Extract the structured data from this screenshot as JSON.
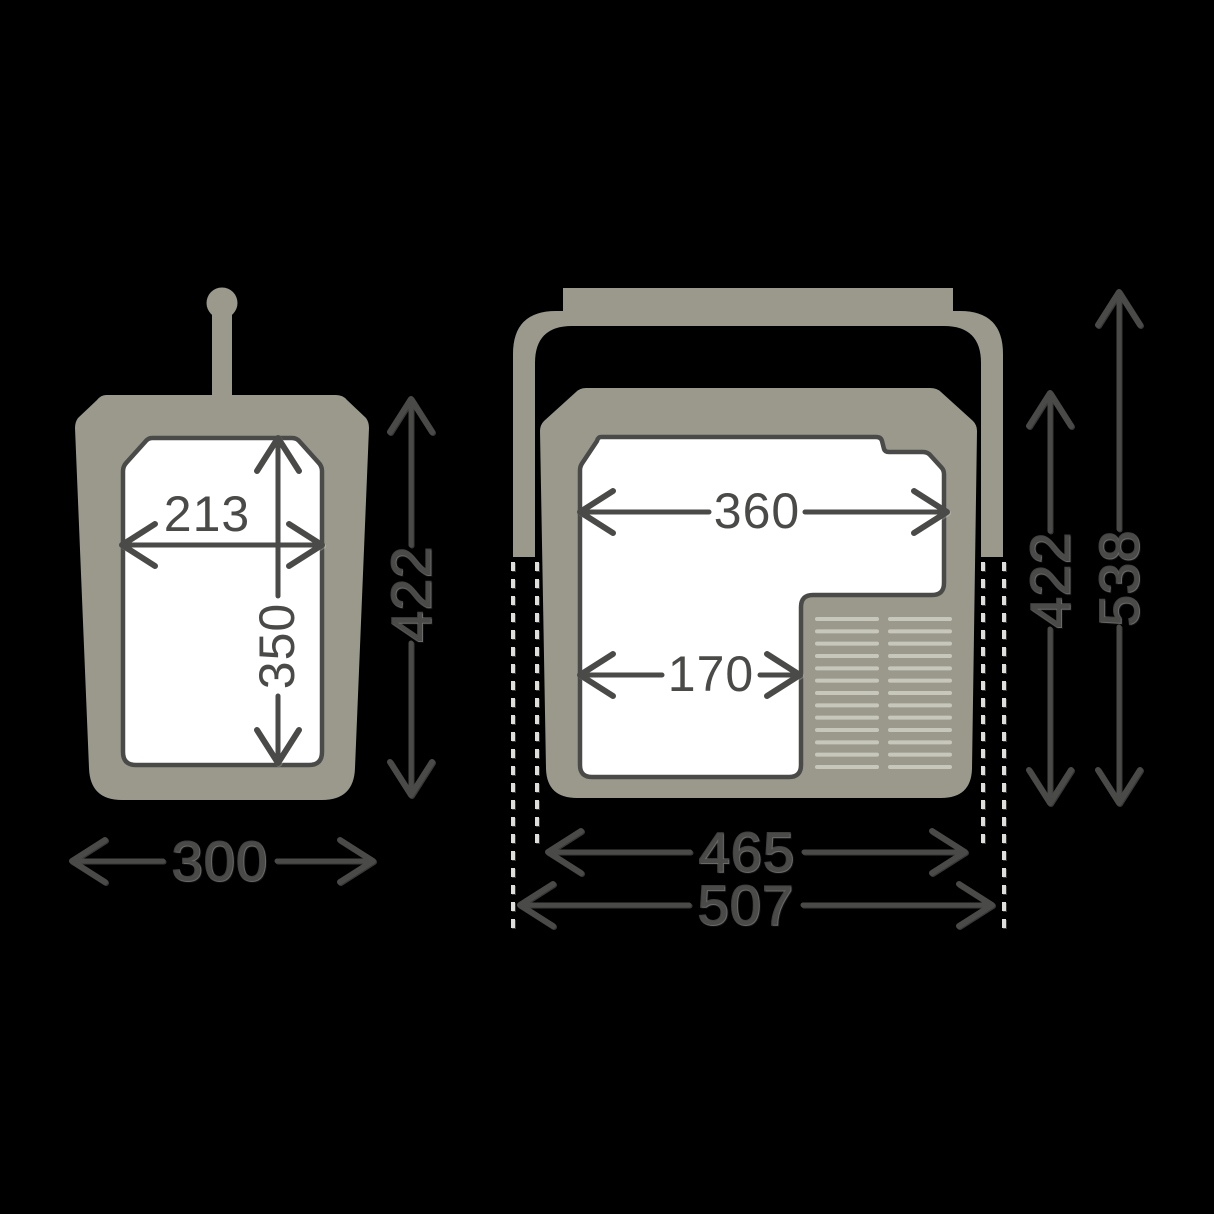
{
  "background_color": "#000000",
  "colors": {
    "body": "#9a998c",
    "outline": "#4a4a48",
    "panel": "#ffffff",
    "vent": "#c8c7bc",
    "dash": "#dededa"
  },
  "diagram": {
    "type": "product-dimension-drawing",
    "subject": "portable cooler box, two orthographic views with millimetre dimensions",
    "views": {
      "side": {
        "name": "side-view",
        "dims": {
          "inner_width": "213",
          "inner_height": "350",
          "outer_height": "422",
          "outer_width": "300"
        }
      },
      "front": {
        "name": "front-view",
        "dims": {
          "inner_width": "360",
          "compartment_width": "170",
          "body_width": "465",
          "overall_width": "507",
          "body_height": "422",
          "overall_height": "538"
        }
      }
    },
    "vents": {
      "columns": [
        {
          "x1": 817,
          "x2": 877
        },
        {
          "x1": 890,
          "x2": 950
        }
      ],
      "y_start": 619,
      "y_end": 767,
      "lines_per_column": 13
    }
  }
}
